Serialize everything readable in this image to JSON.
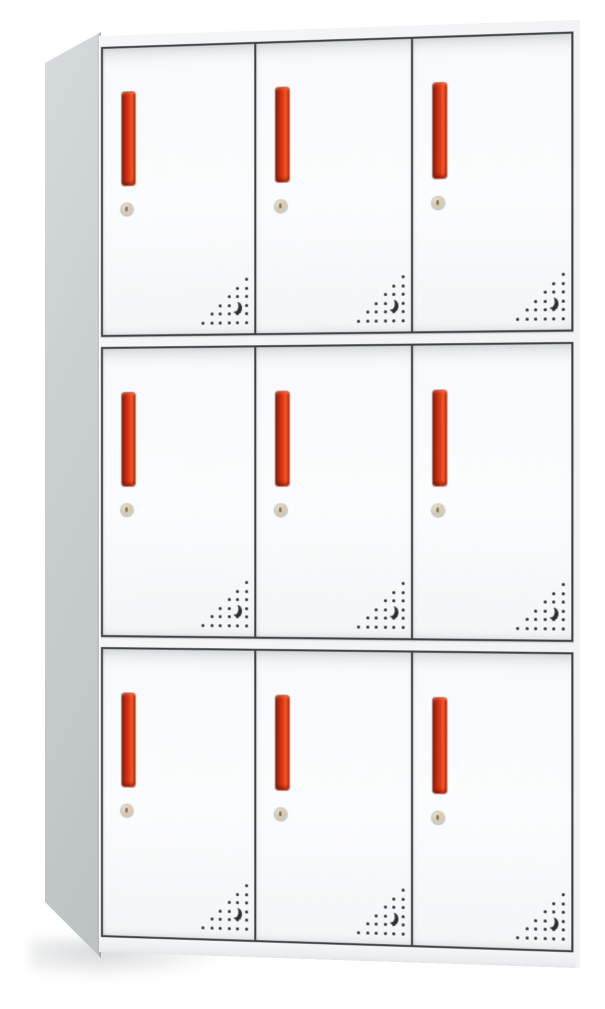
{
  "image_type": "product-photo",
  "subject": "nine-door-metal-locker-cabinet",
  "cabinet": {
    "rows": 3,
    "columns": 3,
    "door_count": 9,
    "door_features": [
      "vertical-red-handle",
      "keyhole-lock",
      "vent-holes"
    ],
    "vent_pattern": {
      "grid_cols": 6,
      "grid_rows": 6,
      "spacing_px": 8.5,
      "dot_px": 3,
      "dots": [
        [
          5,
          0
        ],
        [
          4,
          1
        ],
        [
          5,
          1
        ],
        [
          3,
          2
        ],
        [
          4,
          2
        ],
        [
          5,
          2
        ],
        [
          2,
          3
        ],
        [
          3,
          3
        ],
        [
          5,
          3
        ],
        [
          1,
          4
        ],
        [
          2,
          4
        ],
        [
          3,
          4
        ],
        [
          4,
          4
        ],
        [
          5,
          4
        ],
        [
          0,
          5
        ],
        [
          1,
          5
        ],
        [
          2,
          5
        ],
        [
          3,
          5
        ],
        [
          4,
          5
        ],
        [
          5,
          5
        ]
      ],
      "crescent": [
        4,
        3
      ]
    }
  },
  "colors": {
    "background": "#ffffff",
    "cabinet_body": "#f4f6f7",
    "side_panel_light": "#d5dadb",
    "side_panel_dark": "#bcc2c4",
    "door_face": "#fbfcfd",
    "frame_outline": "#3f4346",
    "handle_red": "#e4401a",
    "handle_red_dark": "#7e1a0a",
    "handle_red_highlight": "#ef5f26",
    "keyhole_ring": "#c6cacc",
    "keyhole_center": "#dcc9a2",
    "vent_dot": "#2b2e31"
  }
}
